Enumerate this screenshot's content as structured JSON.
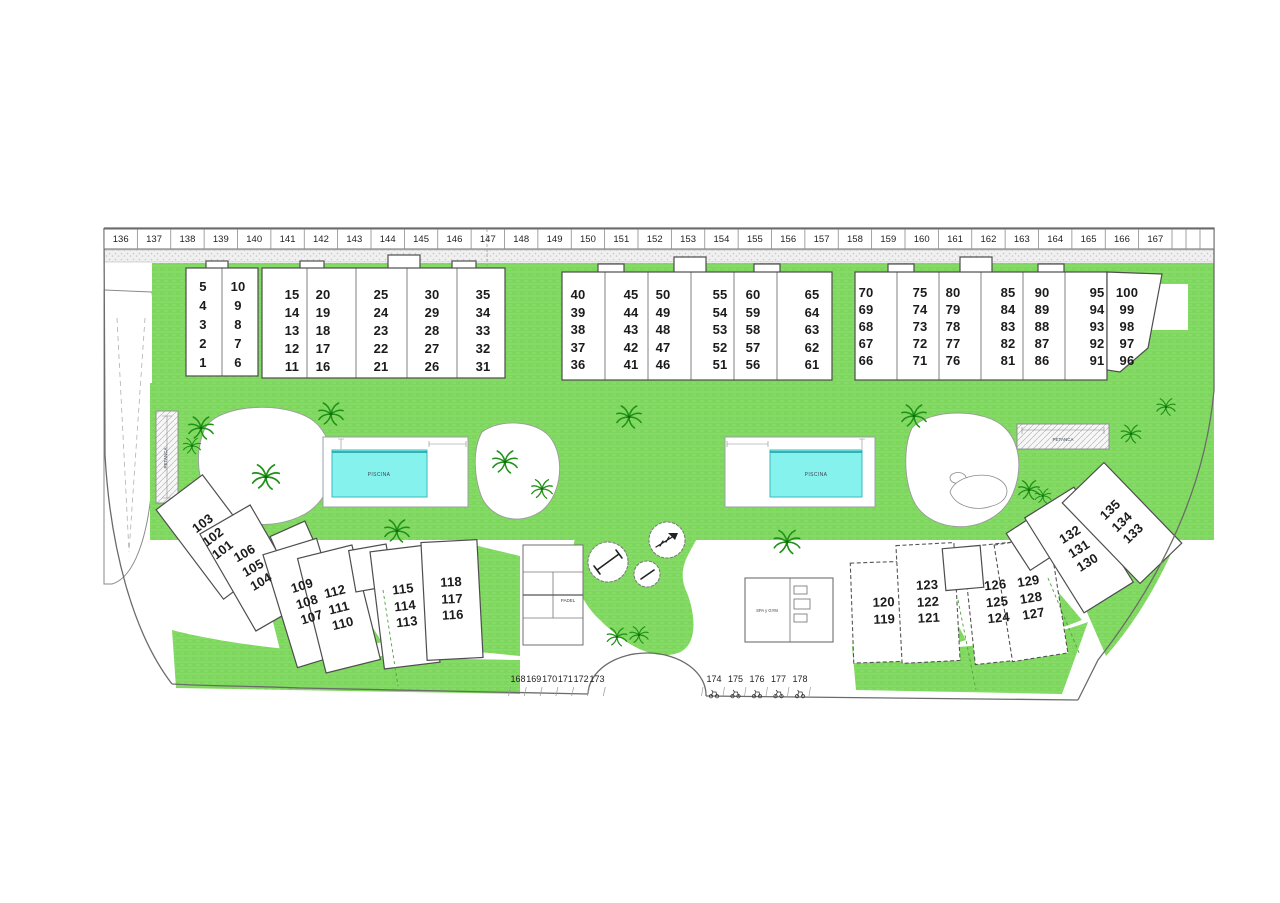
{
  "plan": {
    "parking_top": [
      "136",
      "137",
      "138",
      "139",
      "140",
      "141",
      "142",
      "143",
      "144",
      "145",
      "146",
      "147",
      "148",
      "149",
      "150",
      "151",
      "152",
      "153",
      "154",
      "155",
      "156",
      "157",
      "158",
      "159",
      "160",
      "161",
      "162",
      "163",
      "164",
      "165",
      "166",
      "167"
    ],
    "blocks": [
      {
        "columns": [
          [
            "5",
            "4",
            "3",
            "2",
            "1"
          ],
          [
            "10",
            "9",
            "8",
            "7",
            "6"
          ]
        ]
      },
      {
        "columns": [
          [
            "15",
            "14",
            "13",
            "12",
            "11"
          ],
          [
            "20",
            "19",
            "18",
            "17",
            "16"
          ],
          [
            "25",
            "24",
            "23",
            "22",
            "21"
          ],
          [
            "30",
            "29",
            "28",
            "27",
            "26"
          ],
          [
            "35",
            "34",
            "33",
            "32",
            "31"
          ]
        ]
      },
      {
        "columns": [
          [
            "40",
            "39",
            "38",
            "37",
            "36"
          ],
          [
            "45",
            "44",
            "43",
            "42",
            "41"
          ],
          [
            "50",
            "49",
            "48",
            "47",
            "46"
          ],
          [
            "55",
            "54",
            "53",
            "52",
            "51"
          ],
          [
            "60",
            "59",
            "58",
            "57",
            "56"
          ],
          [
            "65",
            "64",
            "63",
            "62",
            "61"
          ]
        ]
      },
      {
        "columns": [
          [
            "70",
            "69",
            "68",
            "67",
            "66"
          ],
          [
            "75",
            "74",
            "73",
            "72",
            "71"
          ],
          [
            "80",
            "79",
            "78",
            "77",
            "76"
          ],
          [
            "85",
            "84",
            "83",
            "82",
            "81"
          ],
          [
            "90",
            "89",
            "88",
            "87",
            "86"
          ],
          [
            "95",
            "94",
            "93",
            "92",
            "91"
          ],
          [
            "100",
            "99",
            "98",
            "97",
            "96"
          ]
        ]
      }
    ],
    "southwest_buildings": [
      {
        "units": [
          "103",
          "102",
          "101"
        ]
      },
      {
        "units": [
          "106",
          "105",
          "104"
        ]
      },
      {
        "units": [
          "109",
          "108",
          "107"
        ]
      },
      {
        "units": [
          "112",
          "111",
          "110"
        ]
      },
      {
        "units": [
          "115",
          "114",
          "113"
        ]
      },
      {
        "units": [
          "118",
          "117",
          "116"
        ]
      }
    ],
    "southeast_buildings": [
      {
        "units": [
          "120",
          "119"
        ]
      },
      {
        "units": [
          "123",
          "122",
          "121"
        ]
      },
      {
        "units": [
          "126",
          "125",
          "124"
        ]
      },
      {
        "units": [
          "129",
          "128",
          "127"
        ]
      },
      {
        "units": [
          "132",
          "131",
          "130"
        ]
      },
      {
        "units": [
          "135",
          "134",
          "133"
        ]
      }
    ],
    "parking_bottom_left": [
      "168",
      "169",
      "170",
      "171",
      "172",
      "173"
    ],
    "parking_bottom_right": [
      "174",
      "175",
      "176",
      "177",
      "178"
    ],
    "labels": {
      "pool": "PISCINA",
      "petanca": "PETANCA",
      "padel": "PADEL",
      "spa": "SPA y GYM"
    },
    "colors": {
      "lawn_green": "#7ed75d",
      "pool_cyan": "#86f2ee",
      "outline_gray": "#4d4d4d"
    }
  }
}
